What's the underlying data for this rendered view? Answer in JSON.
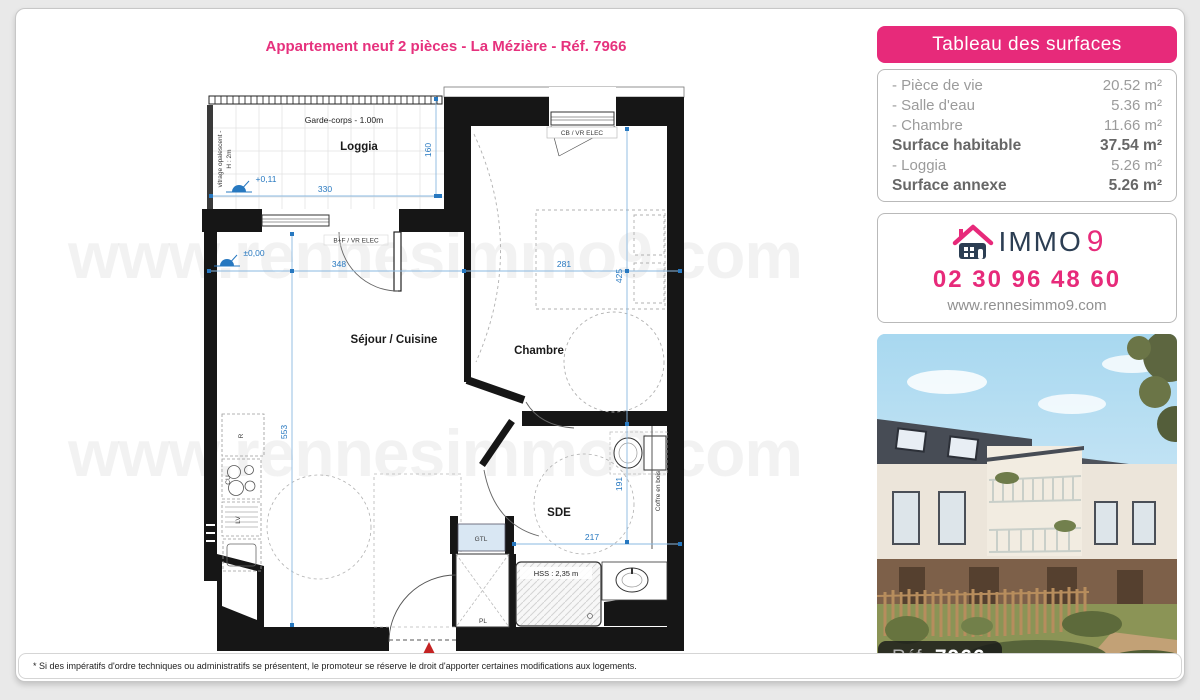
{
  "header": {
    "title": "Appartement neuf 2 pièces - La Mézière - Réf. 7966"
  },
  "watermark": "www.rennesimmo9.com",
  "surfaces": {
    "header": "Tableau des surfaces",
    "rows": [
      {
        "label": "- Pièce de vie",
        "value": "20.52 m²"
      },
      {
        "label": "- Salle d'eau",
        "value": "5.36 m²"
      },
      {
        "label": "- Chambre",
        "value": "11.66 m²"
      },
      {
        "label": "Surface habitable",
        "value": "37.54 m²"
      },
      {
        "label": "- Loggia",
        "value": "5.26 m²"
      },
      {
        "label": "Surface annexe",
        "value": "5.26 m²"
      }
    ]
  },
  "agency": {
    "brand": "IMMO",
    "brand_number": "9",
    "phone": "02 30 96 48 60",
    "website": "www.rennesimmo9.com"
  },
  "photo": {
    "ref_label": "Réf.",
    "ref_value": "7966"
  },
  "plan": {
    "rooms": {
      "loggia": "Loggia",
      "sejour": "Séjour / Cuisine",
      "chambre": "Chambre",
      "sde": "SDE"
    },
    "annotations": {
      "garde_corps": "Garde-corps - 1.00m",
      "vitrage_line1": "vitrage opalescent -",
      "vitrage_line2": "H : 2m",
      "level_loggia": "+0,11",
      "level_sejour": "±0,00",
      "bf_vr": "B+F / VR ELEC",
      "cb_vr": "CB / VR ELEC",
      "hss": "HSS : 2,35 m",
      "coffre": "Coffre en bois",
      "gtl": "GTL",
      "pl": "PL",
      "r": "R",
      "cu": "CU",
      "lv": "LV"
    },
    "dims": {
      "d330": "330",
      "d160": "160",
      "d348": "348",
      "d281": "281",
      "d425": "425",
      "d553": "553",
      "d191": "191",
      "d217": "217"
    }
  },
  "footnote": "* Si des impératifs d'ordre techniques ou administratifs se présentent, le promoteur se réserve le droit d'apporter certaines modifications aux logements.",
  "colors": {
    "accent_pink": "#e72a7a",
    "dimension_blue": "#2778c0",
    "navy": "#2c3e53",
    "wall": "#161616"
  }
}
